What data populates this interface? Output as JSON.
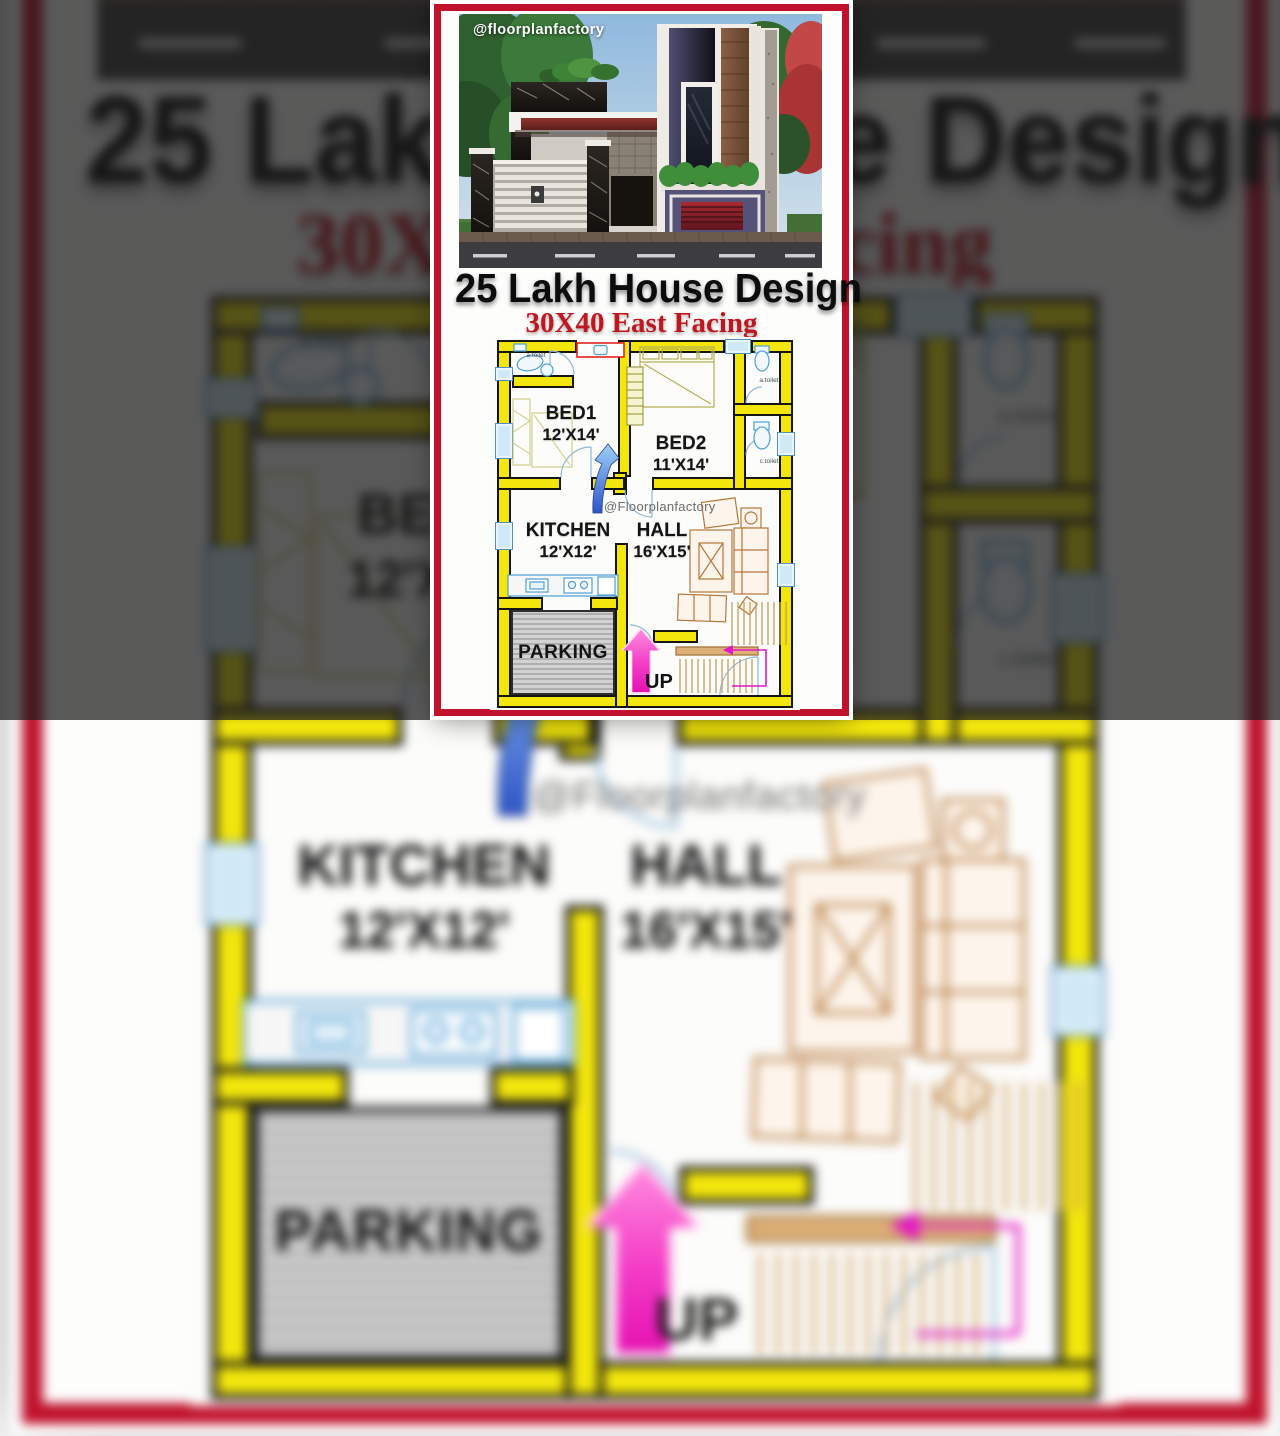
{
  "photo": {
    "watermark": "@floorplanfactory"
  },
  "title": {
    "text": "25 Lakh House Design"
  },
  "subtitle": {
    "text": "30X40 East Facing"
  },
  "plan": {
    "watermark": "@Floorplanfactory",
    "rooms": {
      "bed1": {
        "name": "BED1",
        "size": "12'X14'"
      },
      "bed2": {
        "name": "BED2",
        "size": "11'X14'"
      },
      "kitchen": {
        "name": "KITCHEN",
        "size": "12'X12'"
      },
      "hall": {
        "name": "HALL",
        "size": "16'X15'"
      },
      "parking": {
        "name": "PARKING"
      },
      "up": {
        "label": "UP"
      }
    },
    "toilets": {
      "top_left": "a.toilet",
      "right_top": "a.toilet",
      "right_bottom": "c.toilet"
    },
    "colors": {
      "wall_yellow": "#f2e60c",
      "window_blue": "#cfe9f6",
      "fixture_blue": "#4f9fd4",
      "furniture_tan": "#b5773a",
      "up_arrow_pink": "#e512b2",
      "nav_arrow_blue": "#2e55c8",
      "basin_box_red": "#e22222"
    }
  },
  "colors": {
    "card_border_red": "#c0122c",
    "title_black": "#0c0c0c",
    "subtitle_red": "#c01620",
    "background_dim_gray": "#595959"
  }
}
